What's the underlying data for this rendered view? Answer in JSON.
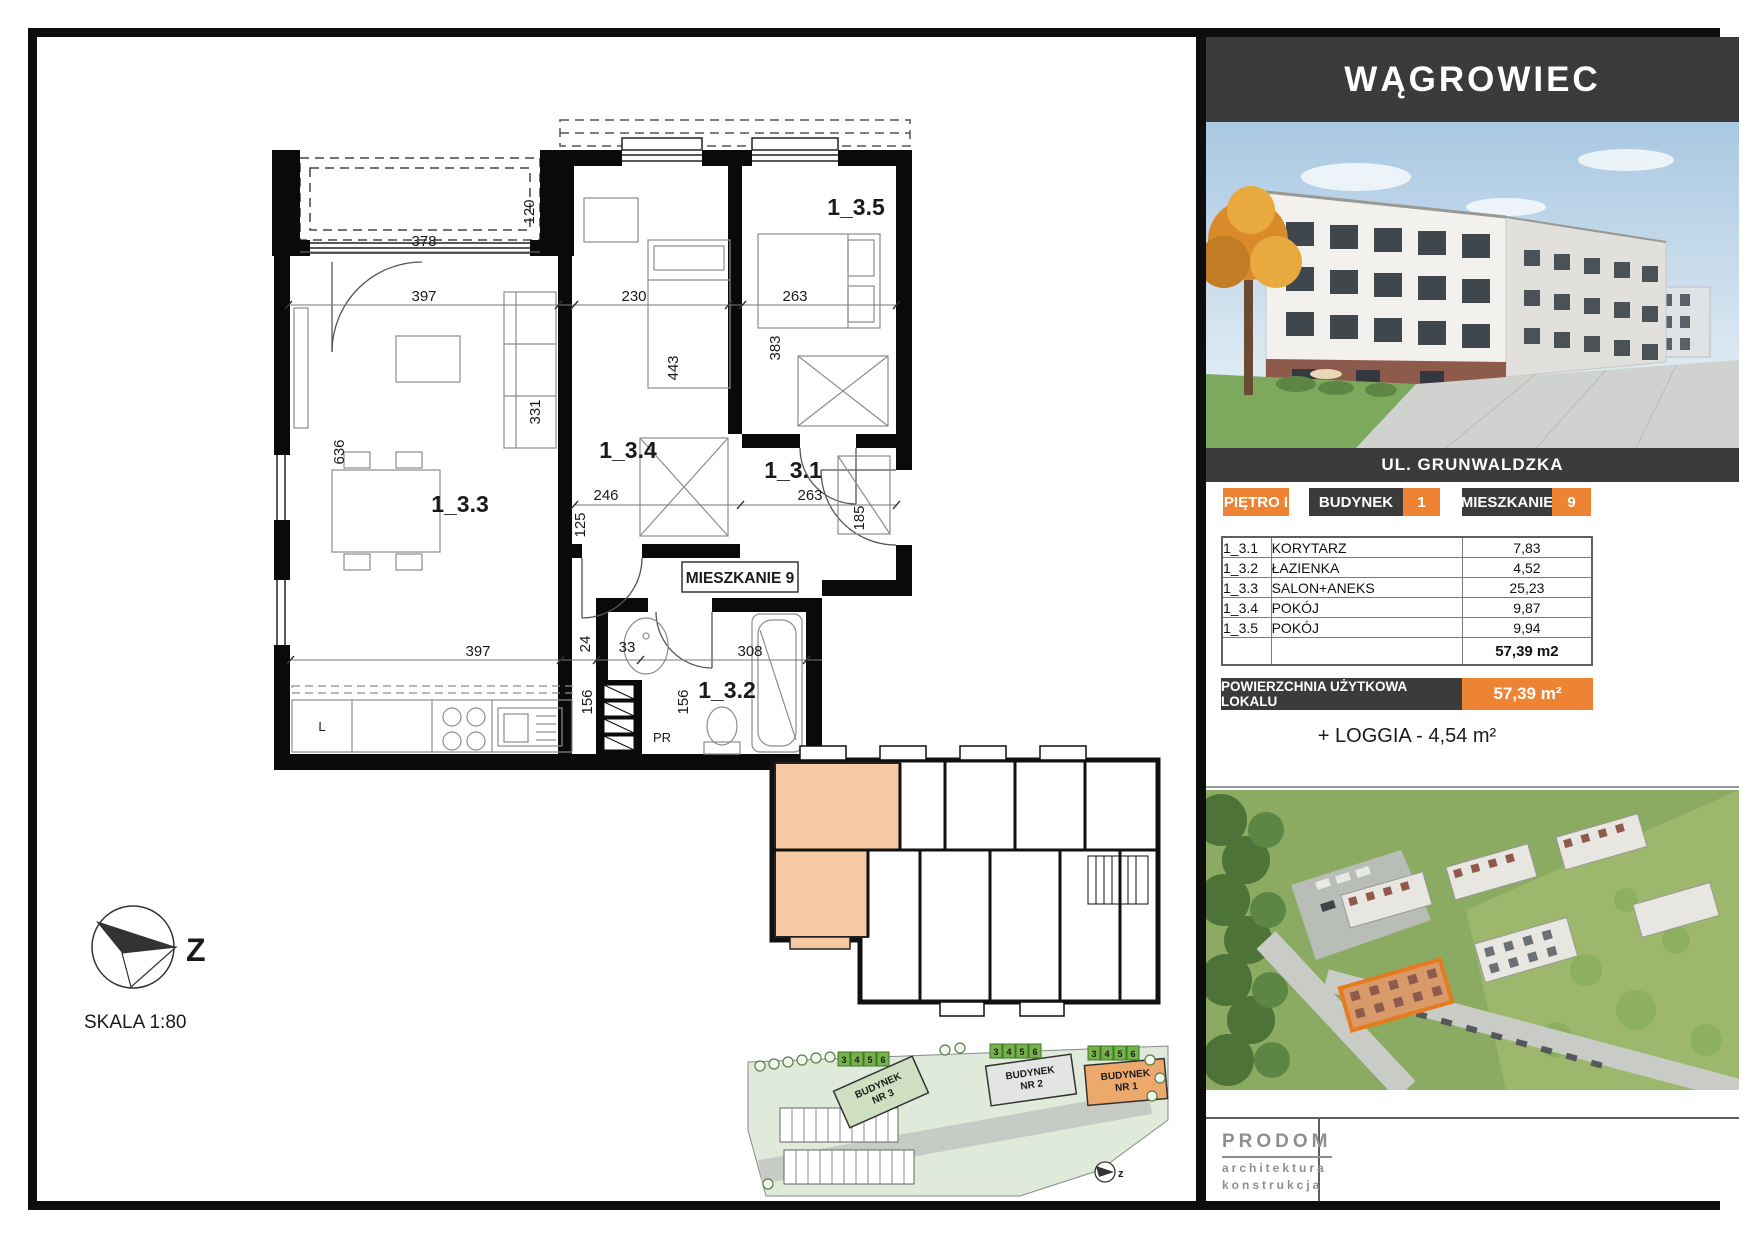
{
  "header": {
    "title": "WĄGROWIEC"
  },
  "photo": {
    "address": "UL. GRUNWALDZKA"
  },
  "info": {
    "floor": "PIĘTRO I",
    "building_label": "BUDYNEK",
    "building_value": "1",
    "apartment_label": "MIESZKANIE",
    "apartment_value": "9"
  },
  "room_table": {
    "rows": [
      {
        "code": "1_3.1",
        "name": "KORYTARZ",
        "area": "7,83"
      },
      {
        "code": "1_3.2",
        "name": "ŁAZIENKA",
        "area": "4,52"
      },
      {
        "code": "1_3.3",
        "name": "SALON+ANEKS",
        "area": "25,23"
      },
      {
        "code": "1_3.4",
        "name": "POKÓJ",
        "area": "9,87"
      },
      {
        "code": "1_3.5",
        "name": "POKÓJ",
        "area": "9,94"
      }
    ],
    "total": "57,39 m2"
  },
  "area_bar": {
    "label": "POWIERZCHNIA UŻYTKOWA LOKALU",
    "value": "57,39 m²"
  },
  "loggia_note": "+ LOGGIA - 4,54 m²",
  "logo": {
    "name": "PRODOM",
    "sub1": "architektura",
    "sub2": "konstrukcja"
  },
  "plan": {
    "scale_label": "SKALA 1:80",
    "north_label": "Z",
    "apartment_tag": "MIESZKANIE 9",
    "rooms": {
      "corridor": "1_3.1",
      "bathroom": "1_3.2",
      "living": "1_3.3",
      "room4": "1_3.4",
      "room5": "1_3.5"
    },
    "fixtures": {
      "fridge": "L",
      "shaft": "PR"
    },
    "dims": {
      "loggia_width": "378",
      "loggia_depth": "120",
      "living_width": "397",
      "room4_width": "230",
      "room5_width": "263",
      "living_height_a": "331",
      "living_height_b": "636",
      "room4_height": "443",
      "room5_height": "383",
      "corridor_width_a": "246",
      "corridor_width_b": "263",
      "corridor_height_a": "125",
      "corridor_height_b": "185",
      "step": "24",
      "kitchen_width": "397",
      "niche": "33",
      "bath_width": "308",
      "bath_height_a": "156",
      "bath_height_b": "156"
    }
  },
  "site_plan": {
    "building1_line1": "BUDYNEK",
    "building1_line2": "NR 1",
    "building2_line1": "BUDYNEK",
    "building2_line2": "NR 2",
    "building3_line1": "BUDYNEK",
    "building3_line2": "NR 3",
    "stalls": [
      "3",
      "4",
      "5",
      "6"
    ],
    "north_label": "z"
  },
  "colors": {
    "accent_orange": "#ee8433",
    "panel_dark": "#3b3b3b"
  }
}
